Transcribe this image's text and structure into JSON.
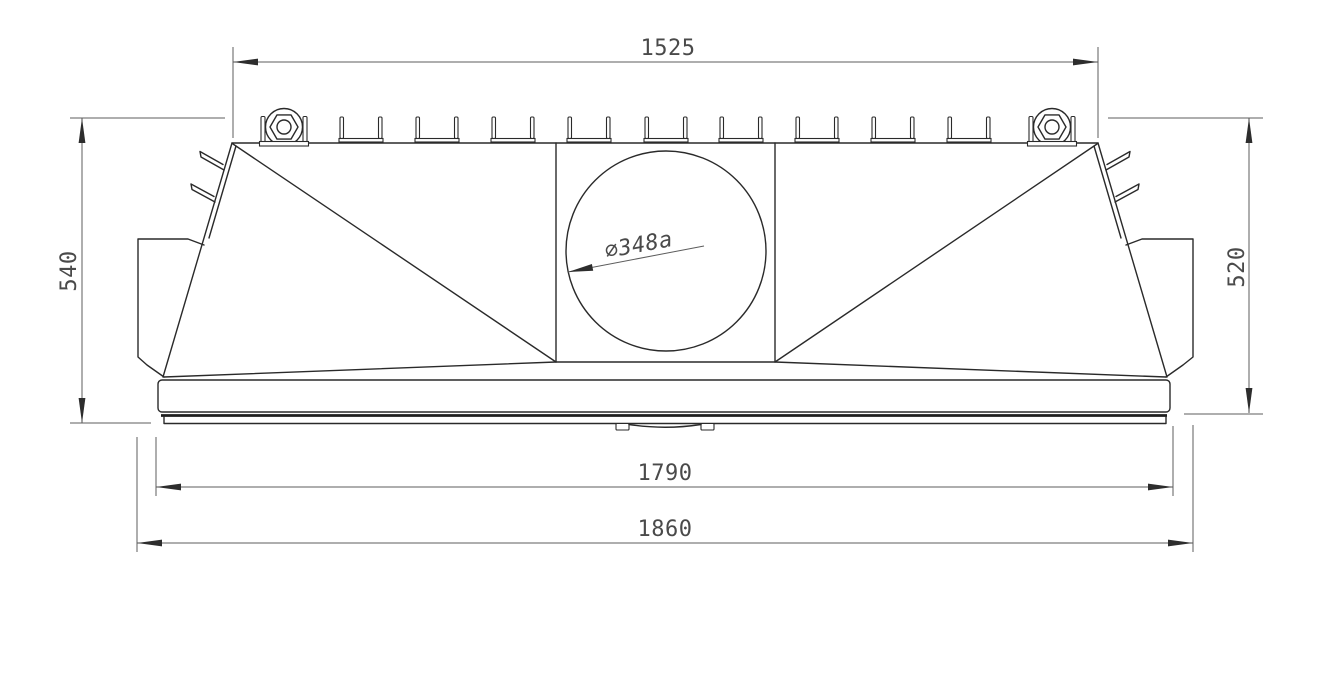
{
  "drawing": {
    "description": "CAD front-view technical drawing of a hood/housing part with top channel clips, two nut fasteners, central circular opening and base plate",
    "dimensions": {
      "top_width": "1525",
      "left_height": "540",
      "right_height": "520",
      "inner_base_width": "1790",
      "overall_base_width": "1860",
      "hole_diameter_label": "⌀348a"
    },
    "colors": {
      "object_line": "#2a2a2a",
      "dimension_line": "#5c5c5c",
      "text": "#4a4a4a",
      "background": "#ffffff"
    }
  }
}
